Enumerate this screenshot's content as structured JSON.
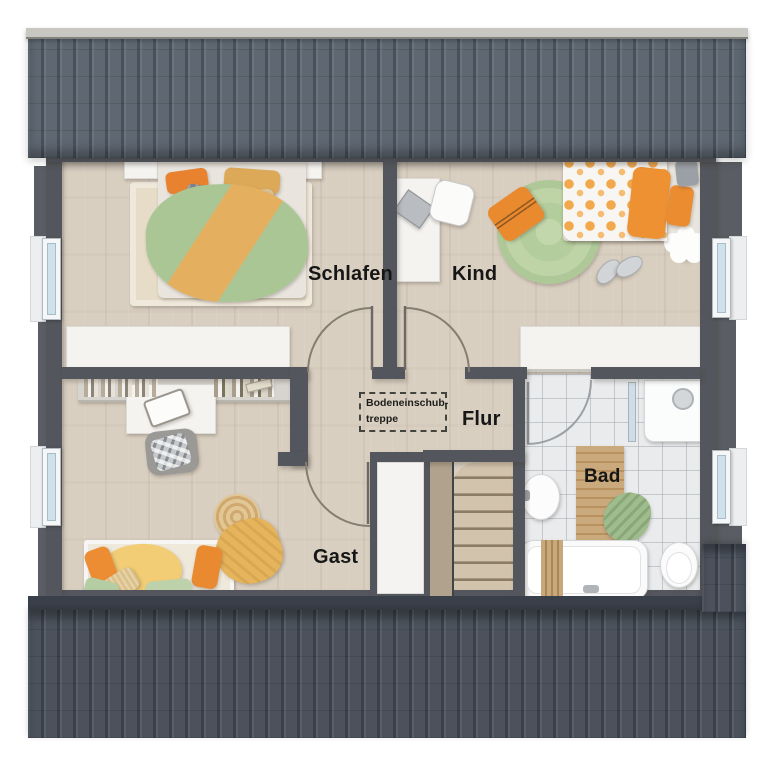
{
  "labels": {
    "bedroom": "Schlafen",
    "child": "Kind",
    "hall": "Flur",
    "guest": "Gast",
    "bath": "Bad",
    "attic_hatch_line1": "Bodeneinschub-",
    "attic_hatch_line2": "treppe"
  },
  "colors": {
    "roof_top": "#5e6772",
    "roof_bottom": "#4b525d",
    "wall": "#53565c",
    "wood_floor": "#d9cfc1",
    "stair_wood": "#cfbfa8",
    "tile_floor": "#e9ebed",
    "window_glass": "#cfe2ec",
    "accent_orange": "#ec8c30",
    "accent_green": "#a9c694",
    "label_text": "#161616"
  }
}
